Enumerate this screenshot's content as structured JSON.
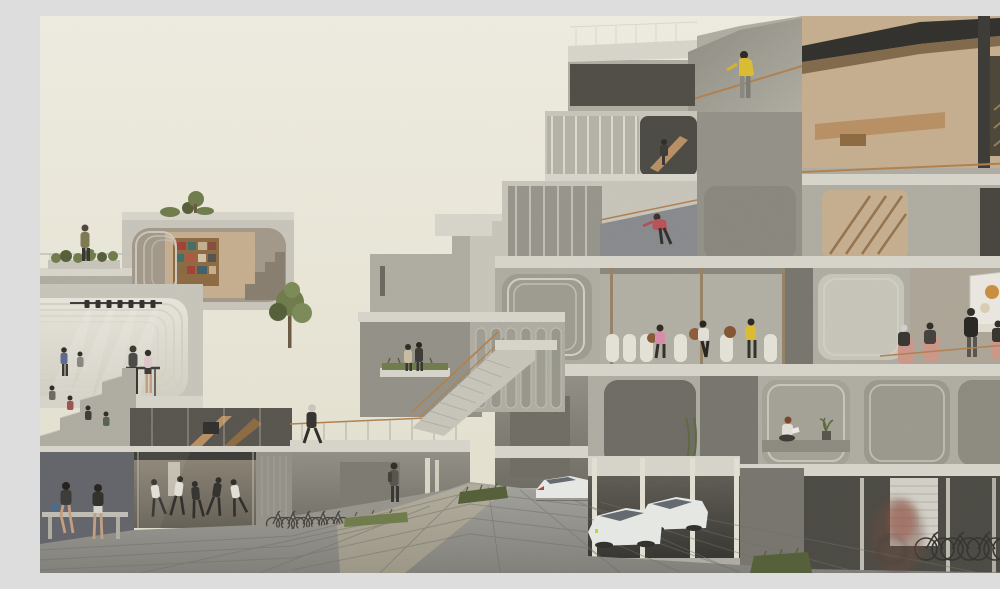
{
  "meta": {
    "kind": "architectural-rendering",
    "subject": "modular concrete housing complex shown in cut-away section around a paved plaza",
    "time_of_day": "soft overcast daylight",
    "text_visible": false
  },
  "palette": {
    "sky_top": "#f6f4e8",
    "sky_mid": "#f0edde",
    "sky_low": "#e9e5d3",
    "conc_light": "#cdcbc0",
    "conc_mid": "#b3b1a6",
    "conc_dark": "#96948a",
    "conc_deep": "#78766e",
    "slab": "#dedcd1",
    "frame": "#d7d5ca",
    "stage_light": "#efede3",
    "interior_dark": "#4a4842",
    "interior_warm": "#cbb392",
    "wood": "#bd9264",
    "wood_dark": "#8f6a40",
    "copper": "#b5824f",
    "plaza_a": "#a7a6a1",
    "plaza_b": "#93928d",
    "plaza_dark": "#82817c",
    "grout": "#6f6e6a",
    "sun": "#d8c9a4",
    "green": "#6f7d4a",
    "green_dark": "#535f37",
    "car_body": "#eef0ed",
    "car_glass": "#636a70",
    "white_chair": "#eceade",
    "salmon": "#d39a8b",
    "people_dark": "#35332f",
    "skin": "#caa183",
    "accent_yellow": "#e2c230",
    "accent_red": "#c05158",
    "accent_pink": "#df8fae",
    "book_red": "#a43f35",
    "book_teal": "#3f6f6a",
    "wall_blue": "#7d8088",
    "screen_white": "#f2efe8"
  },
  "scene": {
    "left_building": {
      "features": [
        "roof terrace with planters and standing person",
        "library module with bookshelf",
        "stage module with seven spotlights and light beams",
        "bleacher seating with audience",
        "standing bar with two people",
        "wooden staircase atrium",
        "dance studio with five dancers",
        "covered bicycle parking",
        "bench with two seated women"
      ]
    },
    "right_building": {
      "features": [
        "roof terrace with person in yellow jacket",
        "interior wooden stairs with person",
        "balcony with stretching person in red",
        "open lounge with white chairs, three seated people and basketballs",
        "presentation room with screen and audience on salmon chairs",
        "reading alcove with woman and potted plant",
        "ground-floor parking with white concept cars",
        "bicycle storage with blurred cyclist",
        "copper handrails",
        "glass balustrades"
      ]
    },
    "center": {
      "features": [
        "background concrete volumes",
        "external staircase with copper handrail",
        "elevated walkway with walking man",
        "ground passage with pedestrian",
        "small tree and grass planters"
      ]
    },
    "plaza": {
      "features": [
        "grid-paved ground",
        "warm sunlight strip",
        "grass edges"
      ]
    },
    "counts": {
      "spotlights": 7,
      "dancers": 5,
      "cars": 3,
      "bicycles_left": 5,
      "bicycles_right": 5,
      "seated_audience_right": 4
    }
  }
}
